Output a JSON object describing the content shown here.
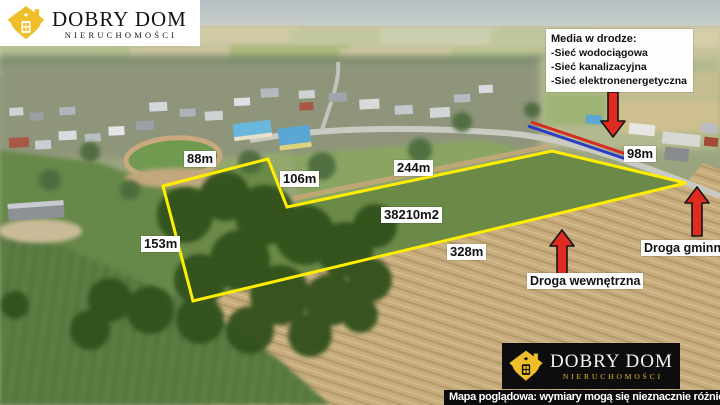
{
  "brand": {
    "name": "DOBRY DOM",
    "subtitle": "NIERUCHOMOŚCI"
  },
  "media_box": {
    "title": "Media w drodze:",
    "lines": [
      "-Sieć wodociągowa",
      "-Sieć kanalizacyjna",
      "-Sieć elektronenergetyczna"
    ]
  },
  "plot": {
    "area_label": "38210m2",
    "edges": {
      "top_left": "88m",
      "notch": "106m",
      "top": "244m",
      "right": "98m",
      "left": "153m",
      "bottom": "328m"
    }
  },
  "roads": {
    "gminna": "Droga gminna",
    "wewnetrzna": "Droga wewnętrzna"
  },
  "footer": {
    "note": "Mapa poglądowa: wymiary mogą się nieznacznie różnić"
  },
  "colors": {
    "plot_outline": "#ffee00",
    "arrow_red": "#e02b20",
    "water_line_blue": "#2a3cc8",
    "power_line_red": "#d92a20",
    "brand_gold": "#efbf2a"
  }
}
